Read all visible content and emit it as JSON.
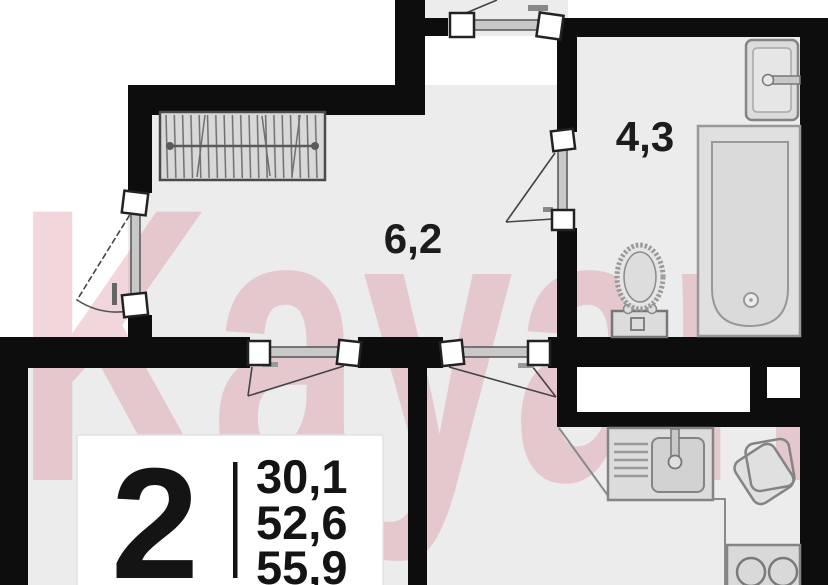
{
  "meta": {
    "title": "2-room apartment floor plan",
    "watermark": "Kayan"
  },
  "labels": {
    "hallway_area": "6,2",
    "bathroom_area": "4,3"
  },
  "info_card": {
    "rooms_count": "2",
    "area_values": [
      "30,1",
      "52,6",
      "55,9"
    ]
  },
  "colors": {
    "wall": "#0d0d0d",
    "floor": "#ececec",
    "outside": "#ffffff",
    "fixture_stroke": "#848484",
    "fixture_fill": "#dedede",
    "watermark_pink": "#d4798b",
    "text": "#1c1c1c"
  }
}
